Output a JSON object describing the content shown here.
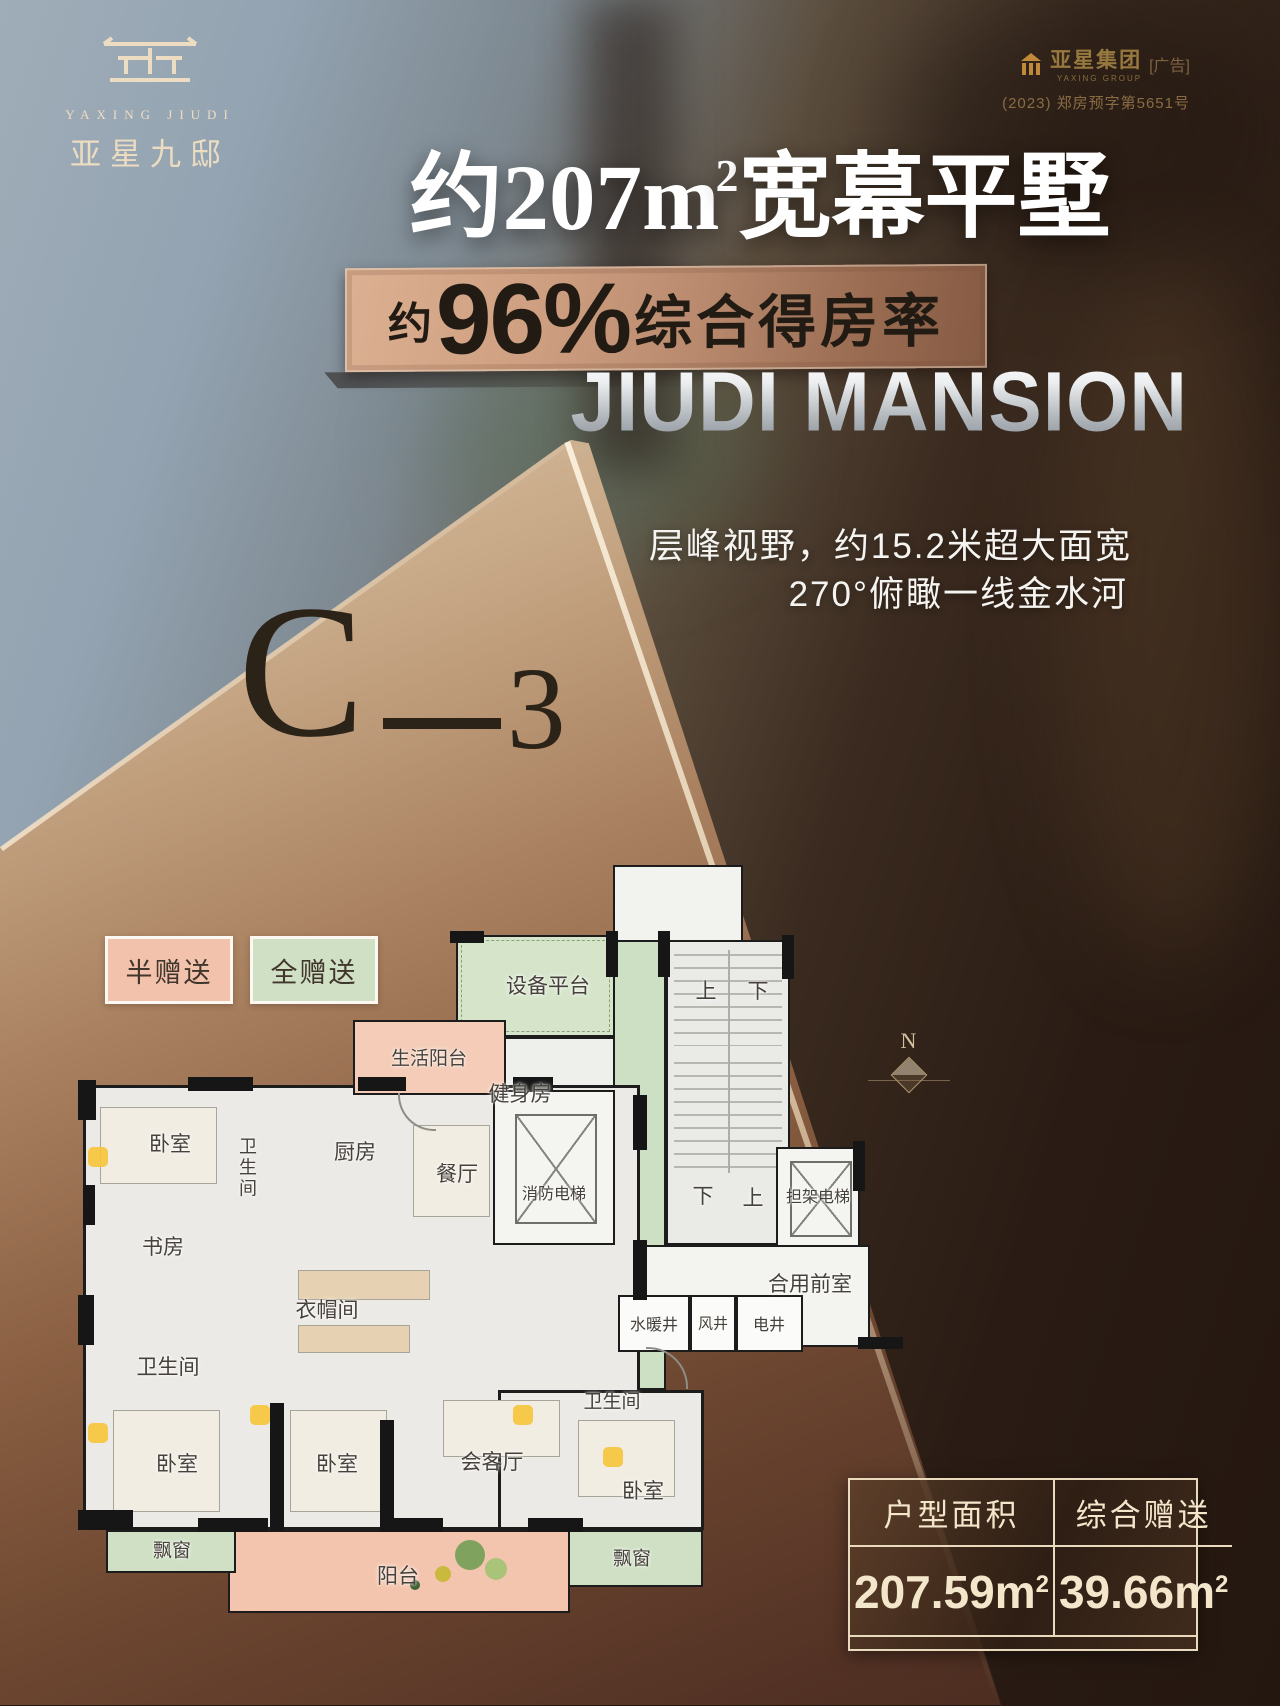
{
  "brand": {
    "logo_en": "YAXING JIUDI",
    "logo_cn": "亚星九邸",
    "corp_name": "亚星集团",
    "corp_en": "YAXING GROUP",
    "corp_ad_tag": "[广告]",
    "corp_permit": "(2023) 郑房预字第5651号"
  },
  "headline": {
    "title_main": "约207m",
    "title_sup": "2",
    "title_tail": "宽幕平墅",
    "banner_prefix": "约",
    "banner_percent": "96%",
    "banner_suffix": "综合得房率",
    "subtitle_en": "JIUDI MANSION",
    "line1": "层峰视野，约15.2米超大面宽",
    "line2": "270°俯瞰一线金水河"
  },
  "unit": {
    "letter": "C",
    "number": "3"
  },
  "legend": [
    {
      "label": "半赠送",
      "color": "#f2c2ac"
    },
    {
      "label": "全赠送",
      "color": "#cfe0c4"
    }
  ],
  "floorplan": {
    "compass": "N",
    "labels": [
      {
        "text": "设备平台"
      },
      {
        "text": "健身房"
      },
      {
        "text": "生活阳台"
      },
      {
        "text": "上"
      },
      {
        "text": "下"
      },
      {
        "text": "消防电梯"
      },
      {
        "text": "下"
      },
      {
        "text": "上"
      },
      {
        "text": "担架电梯"
      },
      {
        "text": "合用前室"
      },
      {
        "text": "水暖井"
      },
      {
        "text": "风井"
      },
      {
        "text": "电井"
      },
      {
        "text": "卧室"
      },
      {
        "text": "卫生间"
      },
      {
        "text": "厨房"
      },
      {
        "text": "餐厅"
      },
      {
        "text": "书房"
      },
      {
        "text": "衣帽间"
      },
      {
        "text": "卫生间"
      },
      {
        "text": "卧室"
      },
      {
        "text": "卧室"
      },
      {
        "text": "会客厅"
      },
      {
        "text": "卫生间"
      },
      {
        "text": "卧室"
      },
      {
        "text": "阳台"
      },
      {
        "text": "飘窗"
      },
      {
        "text": "飘窗"
      }
    ]
  },
  "table": {
    "col1": {
      "header": "户型面积",
      "value": "207.59m",
      "sup": "2"
    },
    "col2": {
      "header": "综合赠送",
      "value": "39.66m",
      "sup": "2"
    }
  }
}
